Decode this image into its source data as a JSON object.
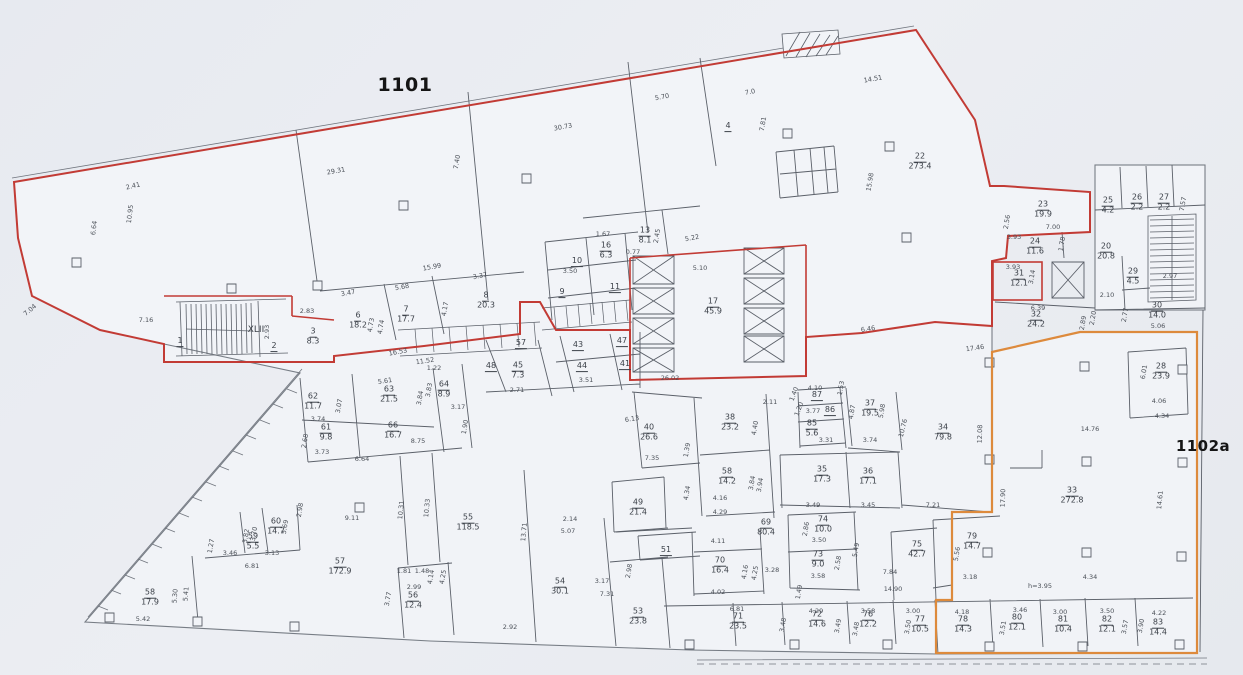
{
  "plan": {
    "label_1101": "1101",
    "label_1102a": "1102a",
    "stair_label": "XLII"
  },
  "colors": {
    "outline_1101": "#c23b35",
    "outline_1102a": "#dd8a3c",
    "paper": "#e9ecf1",
    "floor": "#f2f4f8",
    "wall": "#5b6069",
    "ink": "#3c4149"
  },
  "texts": [
    {
      "t": "XLII",
      "x": 256,
      "y": 330
    }
  ],
  "rooms": [
    {
      "n": "1",
      "a": "",
      "x": 180,
      "y": 342
    },
    {
      "n": "2",
      "a": "",
      "x": 274,
      "y": 347
    },
    {
      "n": "3",
      "a": "8.3",
      "x": 313,
      "y": 337
    },
    {
      "n": "4",
      "a": "",
      "x": 728,
      "y": 127
    },
    {
      "n": "6",
      "a": "18.2",
      "x": 358,
      "y": 321
    },
    {
      "n": "7",
      "a": "17.7",
      "x": 406,
      "y": 315
    },
    {
      "n": "8",
      "a": "20.3",
      "x": 486,
      "y": 301
    },
    {
      "n": "9",
      "a": "",
      "x": 562,
      "y": 293
    },
    {
      "n": "10",
      "a": "",
      "x": 577,
      "y": 262
    },
    {
      "n": "11",
      "a": "",
      "x": 615,
      "y": 288
    },
    {
      "n": "13",
      "a": "8.1",
      "x": 645,
      "y": 236
    },
    {
      "n": "16",
      "a": "6.3",
      "x": 606,
      "y": 251
    },
    {
      "n": "17",
      "a": "45.9",
      "x": 713,
      "y": 307
    },
    {
      "n": "22",
      "a": "273.4",
      "x": 920,
      "y": 162
    },
    {
      "n": "23",
      "a": "19.9",
      "x": 1043,
      "y": 210
    },
    {
      "n": "24",
      "a": "11.6",
      "x": 1035,
      "y": 247
    },
    {
      "n": "25",
      "a": "4.2",
      "x": 1108,
      "y": 206
    },
    {
      "n": "26",
      "a": "2.2",
      "x": 1137,
      "y": 203
    },
    {
      "n": "27",
      "a": "2.2",
      "x": 1164,
      "y": 203
    },
    {
      "n": "20",
      "a": "20.8",
      "x": 1106,
      "y": 252
    },
    {
      "n": "29",
      "a": "4.5",
      "x": 1133,
      "y": 277
    },
    {
      "n": "30",
      "a": "14.0",
      "x": 1157,
      "y": 311
    },
    {
      "n": "31",
      "a": "12.1",
      "x": 1019,
      "y": 279
    },
    {
      "n": "32",
      "a": "24.2",
      "x": 1036,
      "y": 320
    },
    {
      "n": "28",
      "a": "23.9",
      "x": 1161,
      "y": 372
    },
    {
      "n": "33",
      "a": "272.8",
      "x": 1072,
      "y": 496
    },
    {
      "n": "34",
      "a": "79.8",
      "x": 943,
      "y": 433
    },
    {
      "n": "35",
      "a": "17.3",
      "x": 822,
      "y": 475
    },
    {
      "n": "36",
      "a": "17.1",
      "x": 868,
      "y": 477
    },
    {
      "n": "37",
      "a": "19.5",
      "x": 870,
      "y": 409
    },
    {
      "n": "38",
      "a": "23.2",
      "x": 730,
      "y": 423
    },
    {
      "n": "40",
      "a": "26.6",
      "x": 649,
      "y": 433
    },
    {
      "n": "41",
      "a": "",
      "x": 625,
      "y": 365
    },
    {
      "n": "43",
      "a": "",
      "x": 578,
      "y": 346
    },
    {
      "n": "44",
      "a": "",
      "x": 582,
      "y": 367
    },
    {
      "n": "45",
      "a": "7.3",
      "x": 518,
      "y": 371
    },
    {
      "n": "47",
      "a": "",
      "x": 622,
      "y": 342
    },
    {
      "n": "48",
      "a": "",
      "x": 491,
      "y": 367
    },
    {
      "n": "49",
      "a": "21.4",
      "x": 638,
      "y": 508
    },
    {
      "n": "51",
      "a": "",
      "x": 666,
      "y": 551
    },
    {
      "n": "53",
      "a": "23.8",
      "x": 638,
      "y": 617
    },
    {
      "n": "54",
      "a": "30.1",
      "x": 560,
      "y": 587
    },
    {
      "n": "55",
      "a": "118.5",
      "x": 468,
      "y": 523
    },
    {
      "n": "56",
      "a": "12.4",
      "x": 413,
      "y": 601
    },
    {
      "n": "57",
      "a": "",
      "x": 521,
      "y": 344
    },
    {
      "n": "57",
      "a": "172.9",
      "x": 340,
      "y": 567
    },
    {
      "n": "58",
      "a": "14.2",
      "x": 727,
      "y": 477
    },
    {
      "n": "58",
      "a": "17.9",
      "x": 150,
      "y": 598
    },
    {
      "n": "59",
      "a": "5.5",
      "x": 253,
      "y": 542
    },
    {
      "n": "60",
      "a": "14.7",
      "x": 276,
      "y": 527
    },
    {
      "n": "61",
      "a": "9.8",
      "x": 326,
      "y": 433
    },
    {
      "n": "62",
      "a": "11.7",
      "x": 313,
      "y": 402
    },
    {
      "n": "63",
      "a": "21.5",
      "x": 389,
      "y": 395
    },
    {
      "n": "64",
      "a": "8.9",
      "x": 444,
      "y": 390
    },
    {
      "n": "66",
      "a": "16.7",
      "x": 393,
      "y": 431
    },
    {
      "n": "69",
      "a": "80.4",
      "x": 766,
      "y": 528
    },
    {
      "n": "70",
      "a": "16.4",
      "x": 720,
      "y": 566
    },
    {
      "n": "71",
      "a": "23.5",
      "x": 738,
      "y": 622
    },
    {
      "n": "72",
      "a": "14.6",
      "x": 817,
      "y": 620
    },
    {
      "n": "73",
      "a": "9.0",
      "x": 818,
      "y": 560
    },
    {
      "n": "74",
      "a": "10.0",
      "x": 823,
      "y": 525
    },
    {
      "n": "75",
      "a": "42.7",
      "x": 917,
      "y": 550
    },
    {
      "n": "76",
      "a": "12.2",
      "x": 868,
      "y": 620
    },
    {
      "n": "77",
      "a": "10.5",
      "x": 920,
      "y": 625
    },
    {
      "n": "78",
      "a": "14.3",
      "x": 963,
      "y": 625
    },
    {
      "n": "79",
      "a": "14.7",
      "x": 972,
      "y": 542
    },
    {
      "n": "80",
      "a": "12.1",
      "x": 1017,
      "y": 623
    },
    {
      "n": "81",
      "a": "10.4",
      "x": 1063,
      "y": 625
    },
    {
      "n": "82",
      "a": "12.1",
      "x": 1107,
      "y": 625
    },
    {
      "n": "83",
      "a": "14.4",
      "x": 1158,
      "y": 628
    },
    {
      "n": "85",
      "a": "5.6",
      "x": 812,
      "y": 429
    },
    {
      "n": "86",
      "a": "",
      "x": 830,
      "y": 411
    },
    {
      "n": "87",
      "a": "",
      "x": 817,
      "y": 396
    }
  ],
  "dims": [
    {
      "t": "2.41",
      "x": 133,
      "y": 186,
      "r": -13
    },
    {
      "t": "29.31",
      "x": 336,
      "y": 171,
      "r": -10
    },
    {
      "t": "10.95",
      "x": 130,
      "y": 214,
      "r": -83
    },
    {
      "t": "6.64",
      "x": 94,
      "y": 228,
      "r": -83
    },
    {
      "t": "7.04",
      "x": 30,
      "y": 310,
      "r": -40
    },
    {
      "t": "30.73",
      "x": 563,
      "y": 127,
      "r": -10
    },
    {
      "t": "7.40",
      "x": 457,
      "y": 162,
      "r": -80
    },
    {
      "t": "14.51",
      "x": 873,
      "y": 79,
      "r": -10
    },
    {
      "t": "7.0",
      "x": 750,
      "y": 92,
      "r": -10
    },
    {
      "t": "7.81",
      "x": 763,
      "y": 124,
      "r": -80
    },
    {
      "t": "5.70",
      "x": 662,
      "y": 97,
      "r": -10
    },
    {
      "t": "15.98",
      "x": 870,
      "y": 182,
      "r": -80
    },
    {
      "t": "15.99",
      "x": 432,
      "y": 267,
      "r": -10
    },
    {
      "t": "3.47",
      "x": 348,
      "y": 293,
      "r": -10
    },
    {
      "t": "5.68",
      "x": 402,
      "y": 287,
      "r": -10
    },
    {
      "t": "3.37",
      "x": 480,
      "y": 276,
      "r": -10
    },
    {
      "t": "4.73",
      "x": 371,
      "y": 325,
      "r": -80
    },
    {
      "t": "4.74",
      "x": 381,
      "y": 327,
      "r": -80
    },
    {
      "t": "4.17",
      "x": 445,
      "y": 309,
      "r": -80
    },
    {
      "t": "16.53",
      "x": 398,
      "y": 352,
      "r": -10
    },
    {
      "t": "11.52",
      "x": 425,
      "y": 361,
      "r": -8
    },
    {
      "t": "1.22",
      "x": 434,
      "y": 368,
      "r": 0
    },
    {
      "t": "7.16",
      "x": 146,
      "y": 320
    },
    {
      "t": "2.93",
      "x": 267,
      "y": 332,
      "r": -90
    },
    {
      "t": "2.83",
      "x": 307,
      "y": 311
    },
    {
      "t": "5.10",
      "x": 700,
      "y": 268
    },
    {
      "t": "26.02",
      "x": 670,
      "y": 378
    },
    {
      "t": "6.46",
      "x": 868,
      "y": 329,
      "r": -8
    },
    {
      "t": "5.22",
      "x": 692,
      "y": 238,
      "r": -10
    },
    {
      "t": "1.67",
      "x": 603,
      "y": 234
    },
    {
      "t": "0.77",
      "x": 633,
      "y": 252
    },
    {
      "t": "3.50",
      "x": 570,
      "y": 271
    },
    {
      "t": "2.45",
      "x": 657,
      "y": 236,
      "r": -80
    },
    {
      "t": "5.61",
      "x": 385,
      "y": 381,
      "r": -8
    },
    {
      "t": "3.07",
      "x": 339,
      "y": 406,
      "r": -80
    },
    {
      "t": "3.74",
      "x": 318,
      "y": 419
    },
    {
      "t": "3.73",
      "x": 322,
      "y": 452
    },
    {
      "t": "2.68",
      "x": 305,
      "y": 441,
      "r": -80
    },
    {
      "t": "8.75",
      "x": 418,
      "y": 441
    },
    {
      "t": "6.64",
      "x": 362,
      "y": 459
    },
    {
      "t": "3.84",
      "x": 420,
      "y": 398,
      "r": -80
    },
    {
      "t": "3.83",
      "x": 429,
      "y": 390,
      "r": -80
    },
    {
      "t": "3.17",
      "x": 458,
      "y": 407
    },
    {
      "t": "1.90",
      "x": 465,
      "y": 427,
      "r": -80
    },
    {
      "t": "2.71",
      "x": 517,
      "y": 390
    },
    {
      "t": "3.51",
      "x": 586,
      "y": 380
    },
    {
      "t": "6.13",
      "x": 632,
      "y": 419,
      "r": -8
    },
    {
      "t": "2.11",
      "x": 770,
      "y": 402
    },
    {
      "t": "4.10",
      "x": 815,
      "y": 388
    },
    {
      "t": "1.40",
      "x": 794,
      "y": 394,
      "r": -70
    },
    {
      "t": "1.20",
      "x": 799,
      "y": 409,
      "r": -70
    },
    {
      "t": "3.77",
      "x": 813,
      "y": 411
    },
    {
      "t": "1.53",
      "x": 841,
      "y": 388,
      "r": -80
    },
    {
      "t": "4.87",
      "x": 852,
      "y": 412,
      "r": -80
    },
    {
      "t": "5.98",
      "x": 882,
      "y": 411,
      "r": -80
    },
    {
      "t": "3.31",
      "x": 826,
      "y": 440
    },
    {
      "t": "3.74",
      "x": 870,
      "y": 440
    },
    {
      "t": "10.76",
      "x": 903,
      "y": 428,
      "r": -76
    },
    {
      "t": "12.08",
      "x": 980,
      "y": 434,
      "r": -88
    },
    {
      "t": "1.39",
      "x": 687,
      "y": 450,
      "r": -80
    },
    {
      "t": "7.35",
      "x": 652,
      "y": 458
    },
    {
      "t": "4.40",
      "x": 755,
      "y": 428,
      "r": -80
    },
    {
      "t": "3.84",
      "x": 752,
      "y": 483,
      "r": -80
    },
    {
      "t": "3.94",
      "x": 760,
      "y": 485,
      "r": -80
    },
    {
      "t": "4.16",
      "x": 720,
      "y": 498
    },
    {
      "t": "4.34",
      "x": 687,
      "y": 493,
      "r": -80
    },
    {
      "t": "4.29",
      "x": 720,
      "y": 512
    },
    {
      "t": "3.49",
      "x": 813,
      "y": 505
    },
    {
      "t": "3.45",
      "x": 868,
      "y": 505
    },
    {
      "t": "7.21",
      "x": 933,
      "y": 505
    },
    {
      "t": "4.11",
      "x": 718,
      "y": 541
    },
    {
      "t": "4.02",
      "x": 718,
      "y": 592
    },
    {
      "t": "4.16",
      "x": 745,
      "y": 572,
      "r": -80
    },
    {
      "t": "4.25",
      "x": 755,
      "y": 573,
      "r": -80
    },
    {
      "t": "3.28",
      "x": 772,
      "y": 570
    },
    {
      "t": "2.86",
      "x": 806,
      "y": 529,
      "r": -80
    },
    {
      "t": "3.50",
      "x": 819,
      "y": 540
    },
    {
      "t": "3.58",
      "x": 818,
      "y": 576
    },
    {
      "t": "2.58",
      "x": 838,
      "y": 563,
      "r": -80
    },
    {
      "t": "1.49",
      "x": 799,
      "y": 592,
      "r": -80
    },
    {
      "t": "5.49",
      "x": 856,
      "y": 550,
      "r": -80
    },
    {
      "t": "7.84",
      "x": 890,
      "y": 572
    },
    {
      "t": "14.90",
      "x": 893,
      "y": 589
    },
    {
      "t": "6.81",
      "x": 737,
      "y": 609
    },
    {
      "t": "4.29",
      "x": 816,
      "y": 611
    },
    {
      "t": "3.58",
      "x": 868,
      "y": 611
    },
    {
      "t": "3.00",
      "x": 913,
      "y": 611
    },
    {
      "t": "3.48",
      "x": 783,
      "y": 625,
      "r": -80
    },
    {
      "t": "3.49",
      "x": 838,
      "y": 626,
      "r": -80
    },
    {
      "t": "3.48",
      "x": 856,
      "y": 629,
      "r": -80
    },
    {
      "t": "3.50",
      "x": 908,
      "y": 627,
      "r": -80
    },
    {
      "t": "4.18",
      "x": 962,
      "y": 612
    },
    {
      "t": "3.46",
      "x": 1020,
      "y": 610
    },
    {
      "t": "3.00",
      "x": 1060,
      "y": 612
    },
    {
      "t": "3.50",
      "x": 1107,
      "y": 611
    },
    {
      "t": "4.22",
      "x": 1159,
      "y": 613
    },
    {
      "t": "3.51",
      "x": 1003,
      "y": 628,
      "r": -80
    },
    {
      "t": "3.57",
      "x": 1125,
      "y": 627,
      "r": -80
    },
    {
      "t": "3.90",
      "x": 1141,
      "y": 626,
      "r": -80
    },
    {
      "t": "h=3.95",
      "x": 1040,
      "y": 586
    },
    {
      "t": "4.34",
      "x": 1090,
      "y": 577
    },
    {
      "t": "3.18",
      "x": 970,
      "y": 577
    },
    {
      "t": "5.56",
      "x": 957,
      "y": 554,
      "r": -80
    },
    {
      "t": "14.76",
      "x": 1090,
      "y": 429
    },
    {
      "t": "17.90",
      "x": 1003,
      "y": 498,
      "r": -88
    },
    {
      "t": "6.01",
      "x": 1144,
      "y": 372,
      "r": -80
    },
    {
      "t": "4.06",
      "x": 1159,
      "y": 401
    },
    {
      "t": "4.34",
      "x": 1162,
      "y": 416
    },
    {
      "t": "14.61",
      "x": 1160,
      "y": 500,
      "r": -85
    },
    {
      "t": "17.46",
      "x": 975,
      "y": 348,
      "r": -8
    },
    {
      "t": "2.97",
      "x": 1170,
      "y": 276
    },
    {
      "t": "7.57",
      "x": 1183,
      "y": 204,
      "r": -80
    },
    {
      "t": "7.00",
      "x": 1053,
      "y": 227
    },
    {
      "t": "2.56",
      "x": 1007,
      "y": 222,
      "r": -80
    },
    {
      "t": "3.93",
      "x": 1014,
      "y": 237
    },
    {
      "t": "1.78",
      "x": 1062,
      "y": 244,
      "r": -80
    },
    {
      "t": "3.93",
      "x": 1013,
      "y": 267
    },
    {
      "t": "3.14",
      "x": 1032,
      "y": 277,
      "r": -80
    },
    {
      "t": "2.10",
      "x": 1107,
      "y": 295
    },
    {
      "t": "6.39",
      "x": 1038,
      "y": 308
    },
    {
      "t": "2.20",
      "x": 1093,
      "y": 318,
      "r": -80
    },
    {
      "t": "2.89",
      "x": 1083,
      "y": 323,
      "r": -80
    },
    {
      "t": "2.77",
      "x": 1125,
      "y": 315,
      "r": -80
    },
    {
      "t": "5.06",
      "x": 1158,
      "y": 326
    },
    {
      "t": "9.11",
      "x": 352,
      "y": 518
    },
    {
      "t": "10.31",
      "x": 401,
      "y": 510,
      "r": -85
    },
    {
      "t": "10.33",
      "x": 427,
      "y": 508,
      "r": -85
    },
    {
      "t": "13.71",
      "x": 524,
      "y": 532,
      "r": -85
    },
    {
      "t": "2.92",
      "x": 510,
      "y": 627
    },
    {
      "t": "5.07",
      "x": 568,
      "y": 531
    },
    {
      "t": "2.14",
      "x": 570,
      "y": 519
    },
    {
      "t": "3.17",
      "x": 602,
      "y": 581
    },
    {
      "t": "2.98",
      "x": 629,
      "y": 571,
      "r": -80
    },
    {
      "t": "7.31",
      "x": 607,
      "y": 594
    },
    {
      "t": "1.81",
      "x": 404,
      "y": 571
    },
    {
      "t": "1.48",
      "x": 422,
      "y": 571
    },
    {
      "t": "2.99",
      "x": 414,
      "y": 587
    },
    {
      "t": "4.14",
      "x": 431,
      "y": 577,
      "r": -80
    },
    {
      "t": "4.25",
      "x": 443,
      "y": 577,
      "r": -80
    },
    {
      "t": "3.77",
      "x": 388,
      "y": 599,
      "r": -80
    },
    {
      "t": "5.30",
      "x": 175,
      "y": 596,
      "r": -85
    },
    {
      "t": "5.41",
      "x": 186,
      "y": 594,
      "r": -85
    },
    {
      "t": "5.42",
      "x": 143,
      "y": 619
    },
    {
      "t": "6.81",
      "x": 252,
      "y": 566
    },
    {
      "t": "3.46",
      "x": 230,
      "y": 553
    },
    {
      "t": "3.13",
      "x": 272,
      "y": 553
    },
    {
      "t": "3.70",
      "x": 254,
      "y": 534,
      "r": -80
    },
    {
      "t": "3.82",
      "x": 246,
      "y": 536,
      "r": -80
    },
    {
      "t": "5.69",
      "x": 285,
      "y": 527,
      "r": -80
    },
    {
      "t": "2.98",
      "x": 300,
      "y": 510,
      "r": -80
    },
    {
      "t": "1.27",
      "x": 211,
      "y": 546,
      "r": -80
    }
  ]
}
